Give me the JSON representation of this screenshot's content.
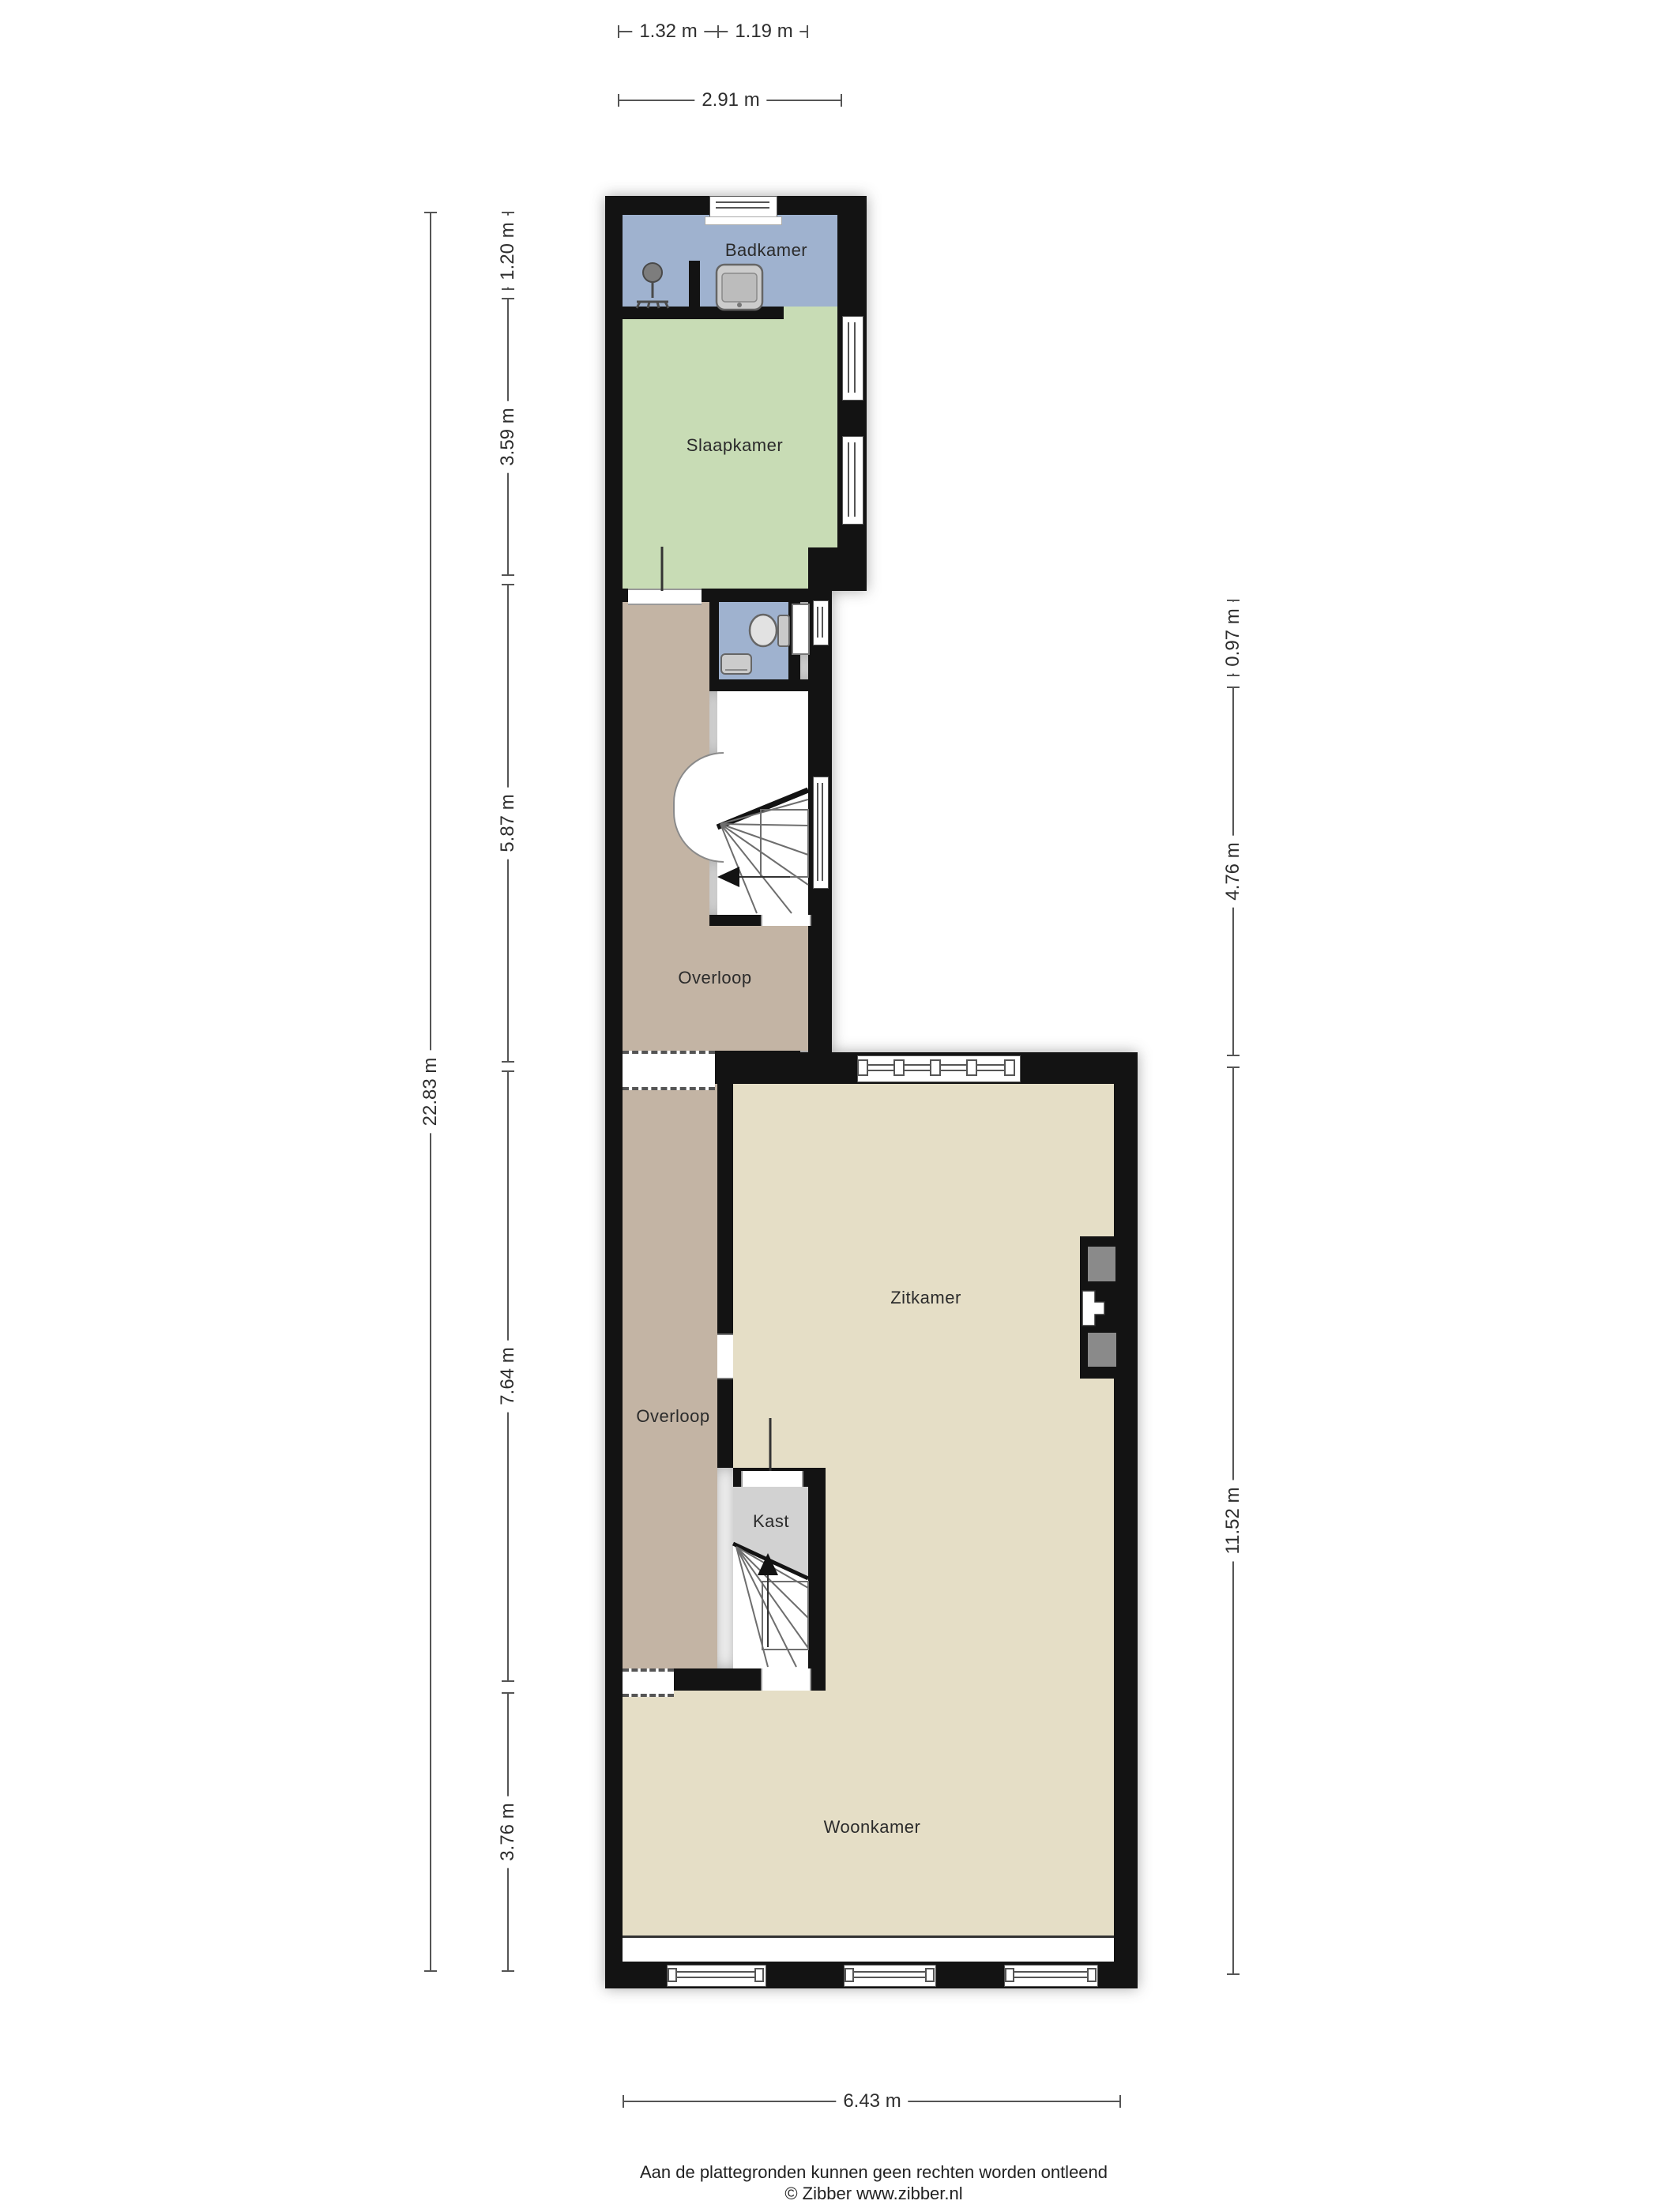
{
  "rooms": {
    "badkamer": {
      "label": "Badkamer"
    },
    "slaapkamer": {
      "label": "Slaapkamer"
    },
    "overloop_boven": {
      "label": "Overloop"
    },
    "zitkamer": {
      "label": "Zitkamer"
    },
    "overloop_beneden": {
      "label": "Overloop"
    },
    "kast": {
      "label": "Kast"
    },
    "woonkamer": {
      "label": "Woonkamer"
    }
  },
  "dimensions": {
    "top": {
      "d132": "1.32 m",
      "d119": "1.19 m",
      "d291": "2.91 m"
    },
    "left": {
      "d120": "1.20 m",
      "d359": "3.59 m",
      "d587": "5.87 m",
      "d764": "7.64 m",
      "d376": "3.76 m",
      "d2283": "22.83 m"
    },
    "right": {
      "d097": "0.97 m",
      "d476": "4.76 m",
      "d1152": "11.52 m"
    },
    "bottom": {
      "d643": "6.43 m"
    }
  },
  "footer": {
    "disclaimer": "Aan de plattegronden kunnen geen rechten worden ontleend",
    "credit": "© Zibber www.zibber.nl"
  },
  "colors": {
    "wall": "#131313",
    "badkamer_blauw": "#9fb2cf",
    "slaapkamer_groen": "#c8dcb5",
    "overloop_taupe": "#c3b4a4",
    "woonruimte_beige": "#e5dec6",
    "kast_grijs": "#d2d2d2"
  }
}
